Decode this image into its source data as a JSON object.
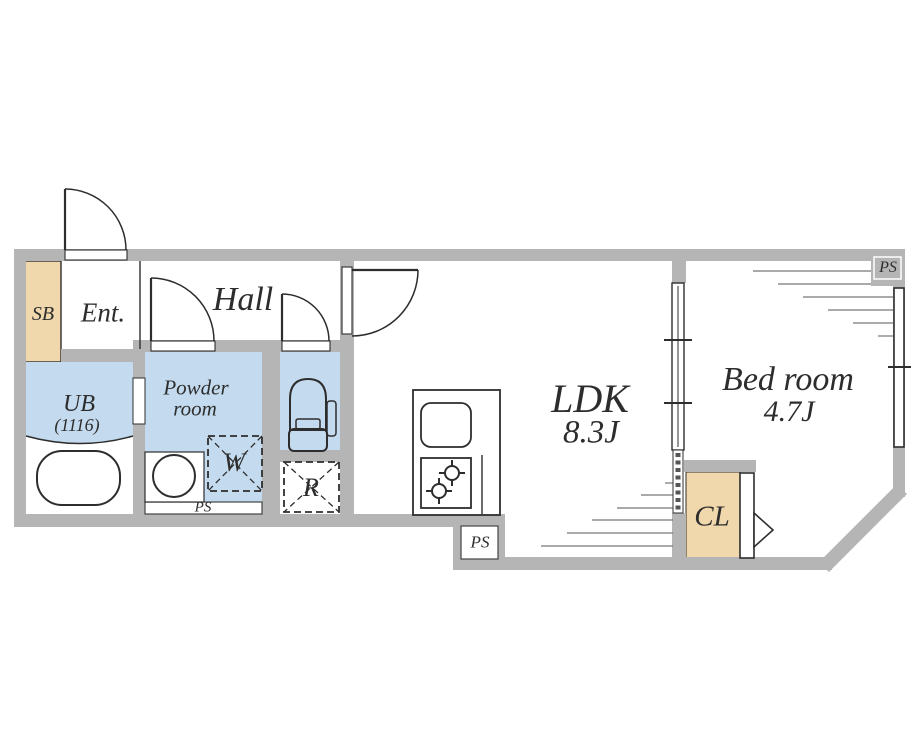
{
  "colors": {
    "wall_gray": "#b5b5b5",
    "wet_area_blue": "#c4daee",
    "storage_tan": "#f0d8ac",
    "line_dark": "#2d2d2d"
  },
  "rooms": {
    "shoe_box": {
      "label": "SB"
    },
    "entrance": {
      "label": "Ent."
    },
    "hall": {
      "label": "Hall"
    },
    "unit_bath": {
      "label": "UB",
      "size": "(1116)"
    },
    "powder_room": {
      "label_line1": "Powder",
      "label_line2": "room"
    },
    "washing_machine": {
      "label": "W"
    },
    "refrigerator": {
      "label": "R"
    },
    "ldk": {
      "label": "LDK",
      "size": "8.3J"
    },
    "bedroom": {
      "label": "Bed room",
      "size": "4.7J"
    },
    "closet": {
      "label": "CL"
    },
    "pipe_space_bath": {
      "label": "PS"
    },
    "pipe_space_kitchen": {
      "label": "PS"
    },
    "pipe_space_bedroom": {
      "label": "PS"
    }
  }
}
